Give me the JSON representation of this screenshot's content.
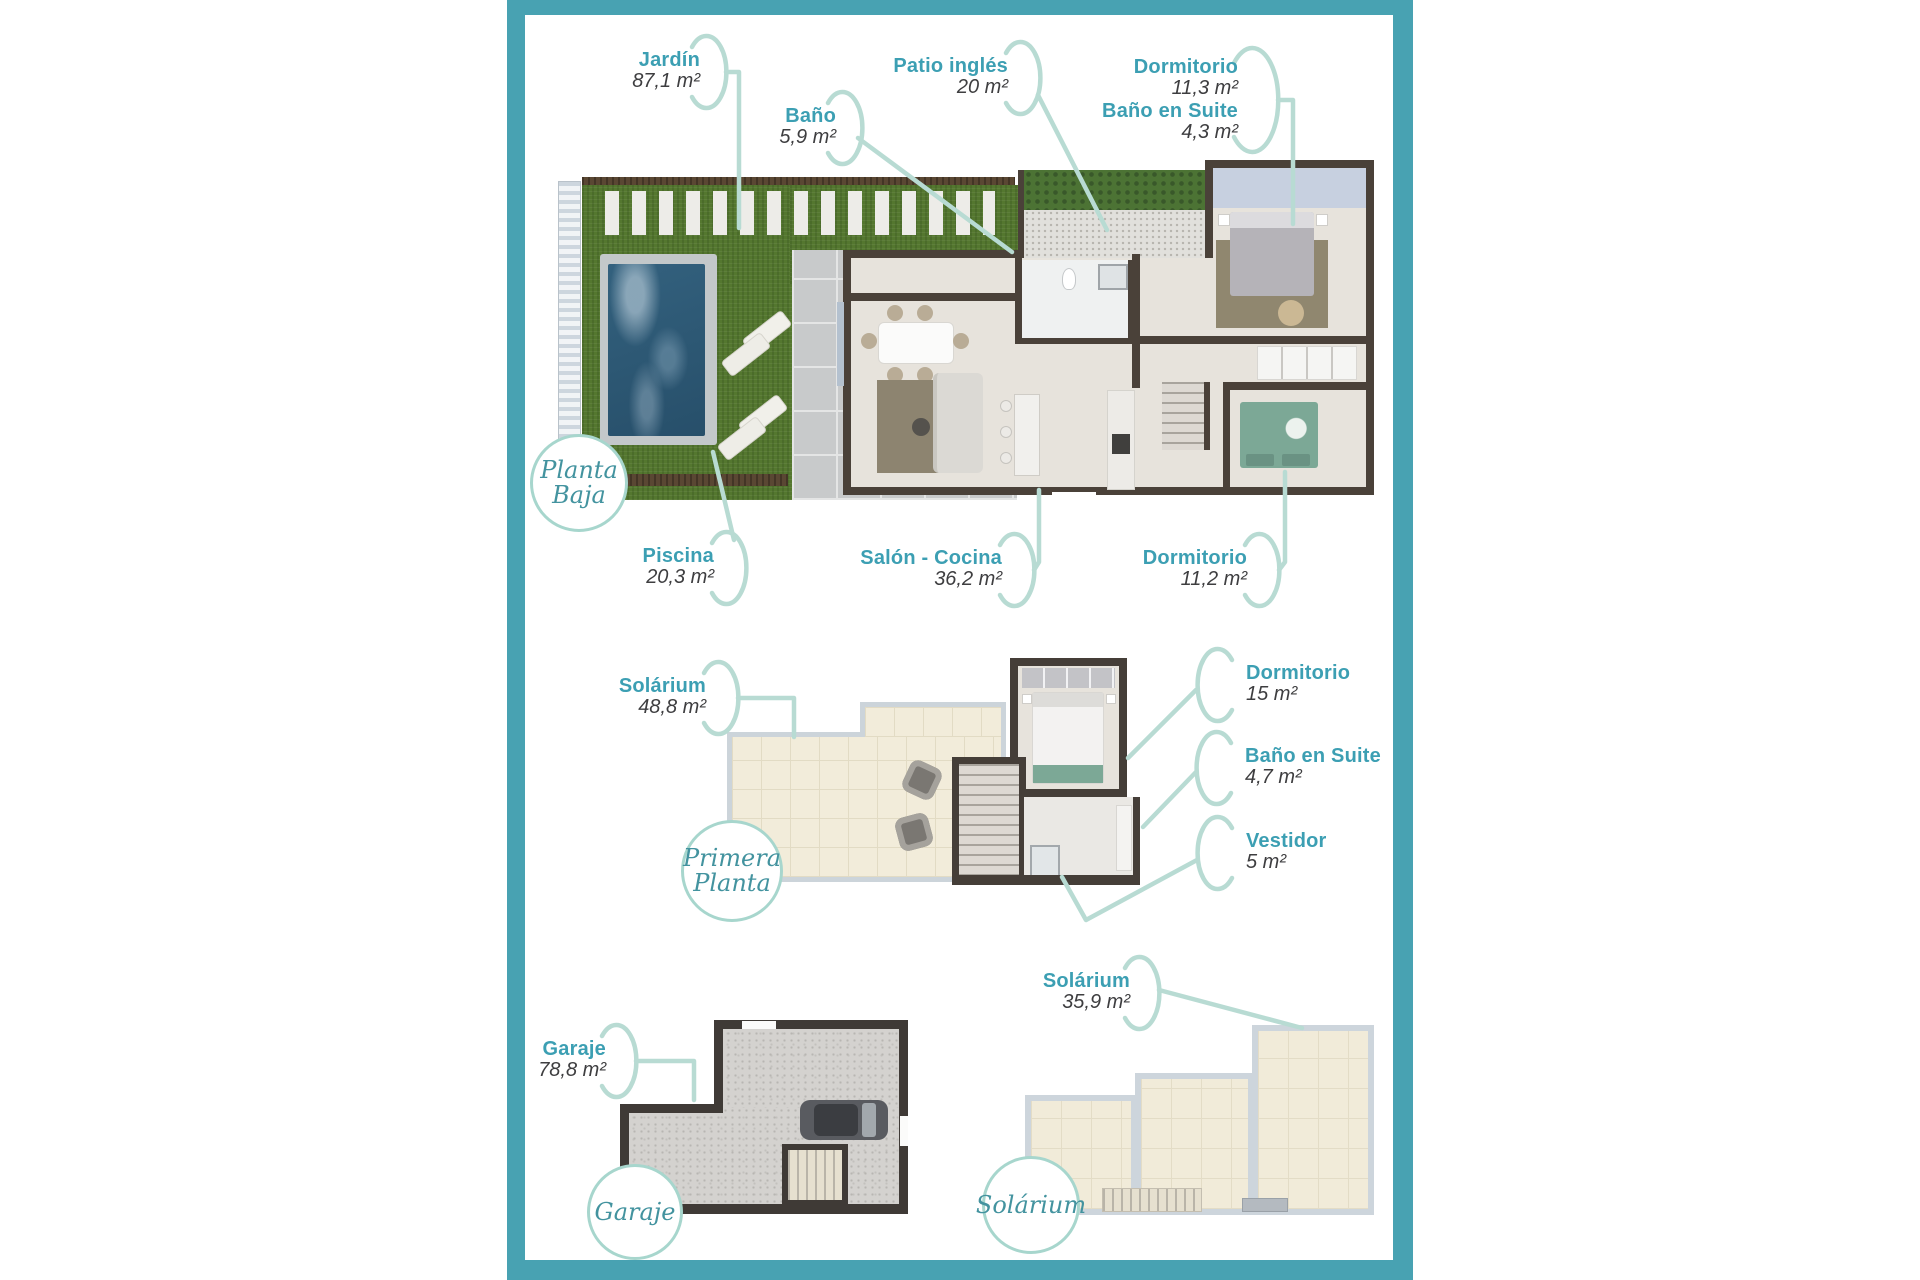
{
  "accent_colors": {
    "frame_teal": "#48a2b2",
    "label_teal": "#3c9fb3",
    "area_text": "#3e3e40",
    "leader_mint": "#b8dbd3",
    "badge_text_teal": "#43939f",
    "badge_border_mint": "#a7d6cd"
  },
  "floors": [
    {
      "id": "planta-baja",
      "badge": [
        "Planta",
        "Baja"
      ],
      "labels": [
        {
          "name": "Jardín",
          "area": "87,1 m²"
        },
        {
          "name": "Baño",
          "area": "5,9 m²"
        },
        {
          "name": "Patio inglés",
          "area": "20 m²"
        },
        {
          "name": "Dormitorio",
          "area": "11,3 m²"
        },
        {
          "name": "Baño en Suite",
          "area": "4,3 m²"
        },
        {
          "name": "Piscina",
          "area": "20,3 m²"
        },
        {
          "name": "Salón - Cocina",
          "area": "36,2 m²"
        },
        {
          "name": "Dormitorio",
          "area": "11,2 m²"
        }
      ]
    },
    {
      "id": "primera-planta",
      "badge": [
        "Primera",
        "Planta"
      ],
      "labels": [
        {
          "name": "Solárium",
          "area": "48,8 m²"
        },
        {
          "name": "Dormitorio",
          "area": "15 m²"
        },
        {
          "name": "Baño en Suite",
          "area": "4,7 m²"
        },
        {
          "name": "Vestidor",
          "area": "5 m²"
        }
      ]
    },
    {
      "id": "garaje",
      "badge": [
        "Garaje"
      ],
      "labels": [
        {
          "name": "Garaje",
          "area": "78,8 m²"
        }
      ]
    },
    {
      "id": "solarium",
      "badge": [
        "Solárium"
      ],
      "labels": [
        {
          "name": "Solárium",
          "area": "35,9 m²"
        }
      ]
    }
  ]
}
